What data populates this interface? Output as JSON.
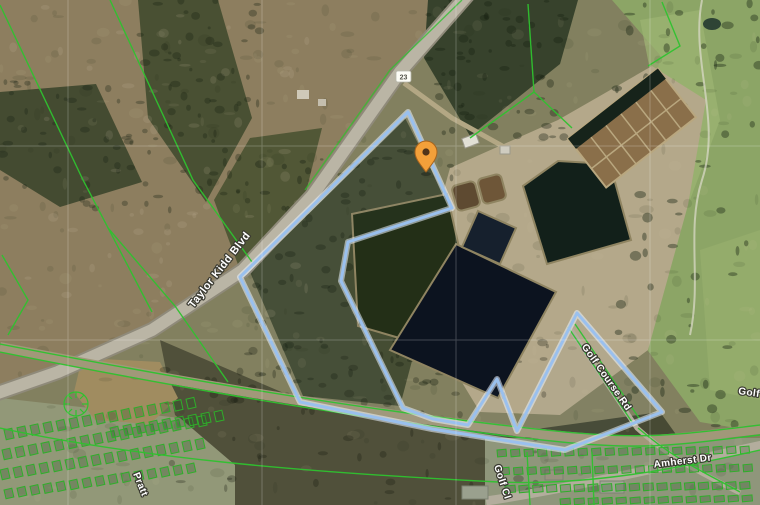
{
  "map": {
    "view_type": "satellite-imagery-with-parcels",
    "labels": {
      "taylor_kidd_blvd": "Taylor Kidd Blvd",
      "golf_course_rd": "Golf Course Rd",
      "amherst_dr": "Amherst Dr",
      "golf_right_clipped": "Golf C",
      "golf_bottom_clipped": "Golf Cl",
      "pratt_st": "Pratt",
      "route_shield": "23"
    },
    "pin": {
      "name": "orange-location-pin",
      "color": "#F3A03A",
      "dot_color": "#50341a"
    },
    "colors": {
      "property_boundary_blue": "#9AC0EE",
      "parcel_line_green": "#2FC22F",
      "water_dark": "#0c131f",
      "golf_green": "#8CA566",
      "field_tan": "#8d7e5f"
    }
  }
}
